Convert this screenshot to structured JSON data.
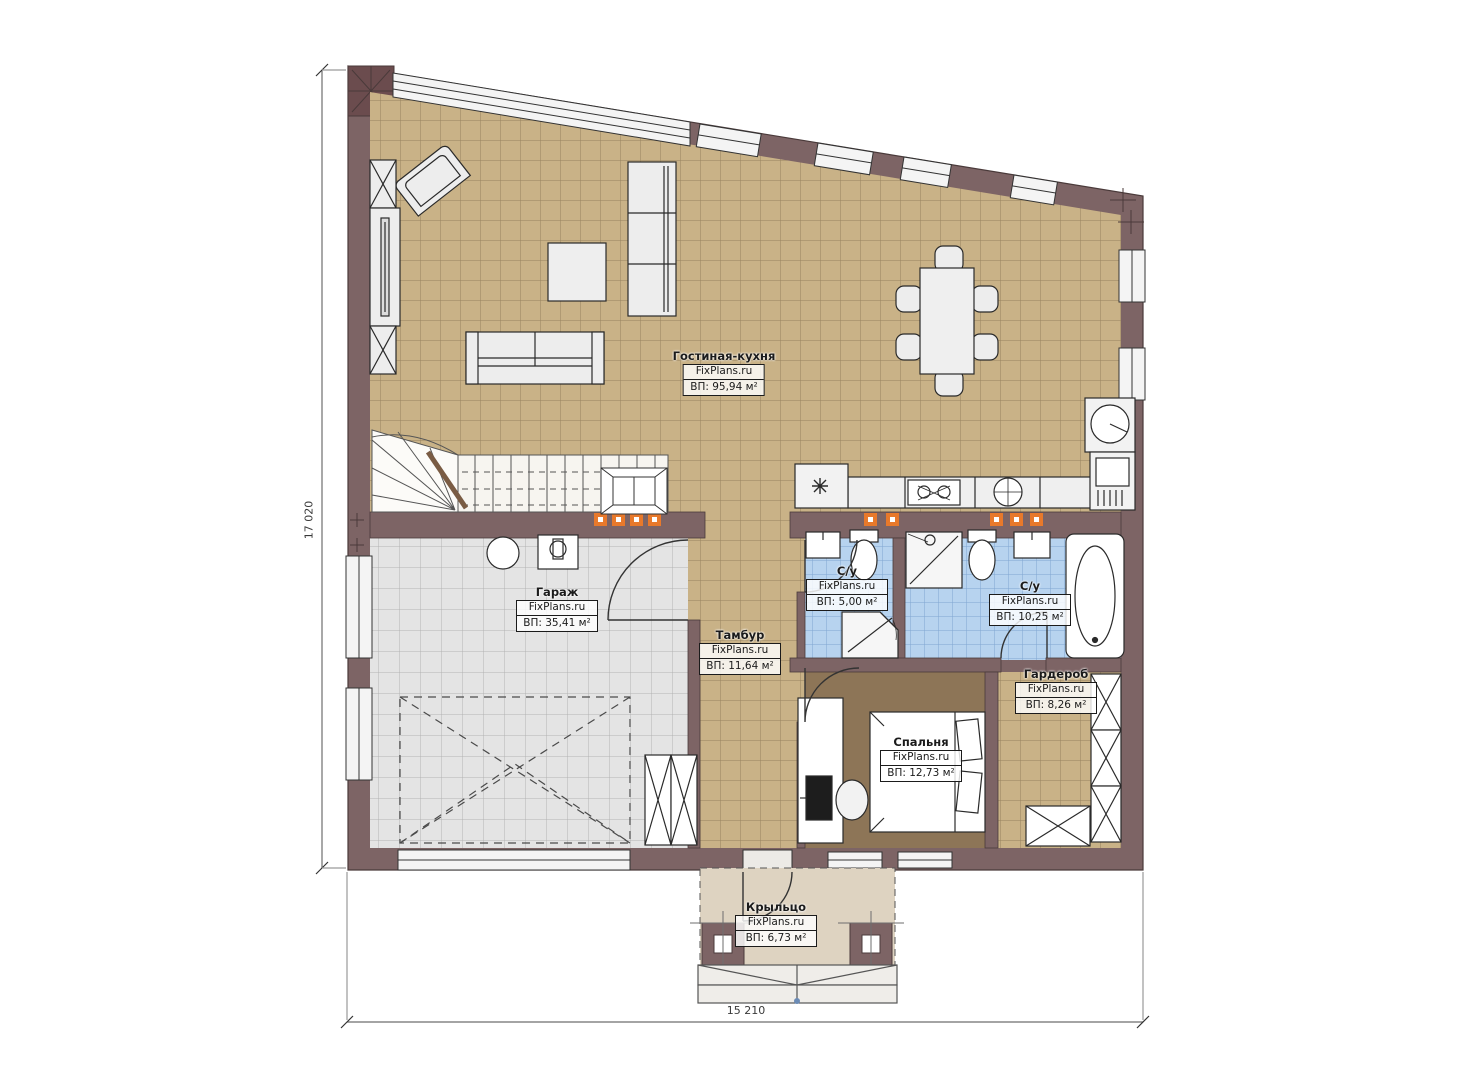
{
  "plan": {
    "brand_watermark": "FixPlans.ru",
    "rooms": [
      {
        "name": "Гостиная-кухня",
        "area": "ВП: 95,94 м²"
      },
      {
        "name": "Гараж",
        "area": "ВП: 35,41 м²"
      },
      {
        "name": "Тамбур",
        "area": "ВП: 11,64 м²"
      },
      {
        "name": "С/у",
        "area": "ВП: 5,00 м²"
      },
      {
        "name": "С/у",
        "area": "ВП: 10,25 м²"
      },
      {
        "name": "Гардероб",
        "area": "ВП: 8,26 м²"
      },
      {
        "name": "Спальня",
        "area": "ВП: 12,73 м²"
      },
      {
        "name": "Крыльцо",
        "area": "ВП: 6,73 м²"
      }
    ],
    "dimensions": {
      "overall_height_mm": "17 020",
      "overall_width_mm": "15 210"
    },
    "colors": {
      "wall": "#7d6465",
      "floor_living": "#c9b287",
      "floor_garage": "#e4e4e4",
      "floor_bath": "#b7d3ef",
      "floor_bedroom": "#8d7557",
      "floor_porch": "#ded3c1",
      "vent_orange": "#e8792b"
    }
  }
}
